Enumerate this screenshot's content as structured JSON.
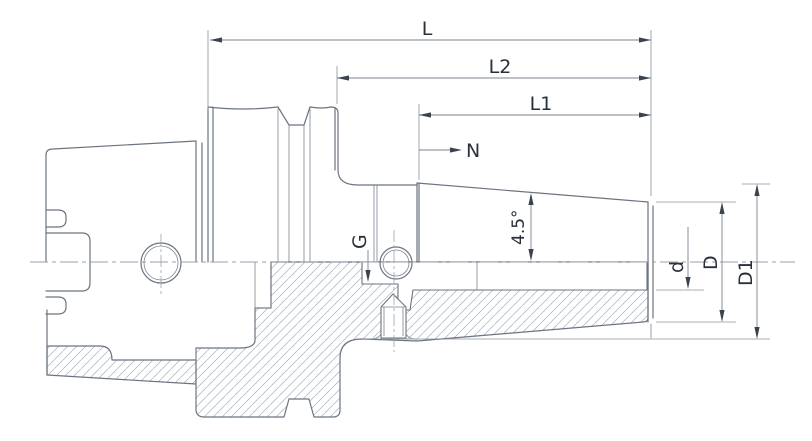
{
  "drawing": {
    "dimension_labels": {
      "overall_length": "L",
      "length_l2": "L2",
      "length_l1": "L1",
      "nose_length": "N",
      "thread": "G",
      "taper_angle": "4.5°",
      "bore_diameter": "d",
      "nose_diameter": "D",
      "large_end_diameter": "D1"
    },
    "colors": {
      "background": "#ffffff",
      "part_outline": "#6b7480",
      "hatch_lines": "#a9b1ba",
      "dimension_lines": "#7a8391",
      "label_text": "#28303a",
      "centerline": "#99a1ac"
    }
  }
}
